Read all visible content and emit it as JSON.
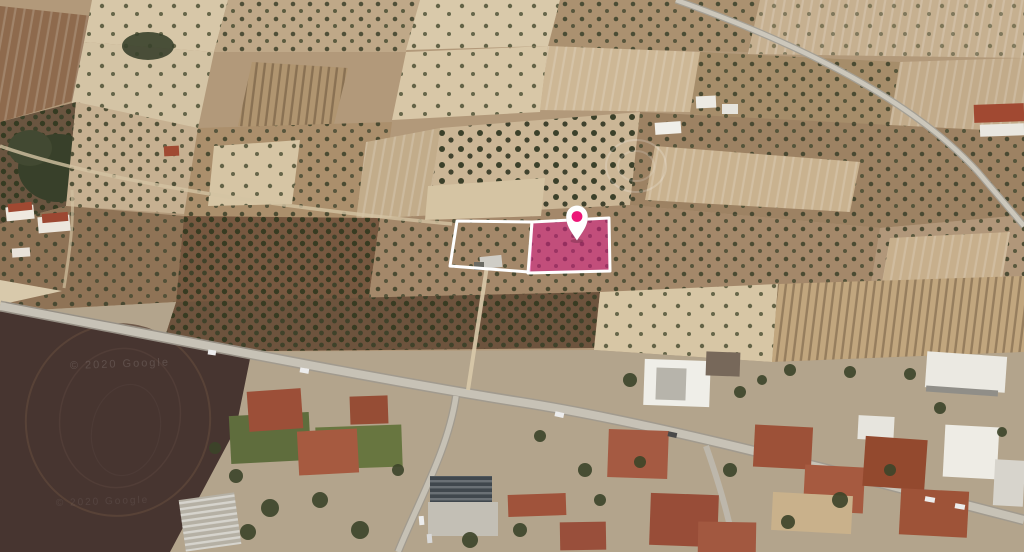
{
  "map": {
    "watermark_primary": "© 2020 Google",
    "watermark_secondary": "© 2020 Google"
  },
  "annotation": {
    "adjacent_plot_points": "457,221 532,222 529,272 450,266",
    "highlighted_plot_points": "532,222 609,218 610,271 528,273",
    "pin_transform": "translate(577,217)"
  },
  "colors": {
    "plot_highlight": "#E0148C",
    "plot_highlight_opacity": "0.5",
    "plot_outline": "#FFFFFF",
    "pin_body": "#FFFFFF",
    "pin_dot": "#EC1677"
  }
}
